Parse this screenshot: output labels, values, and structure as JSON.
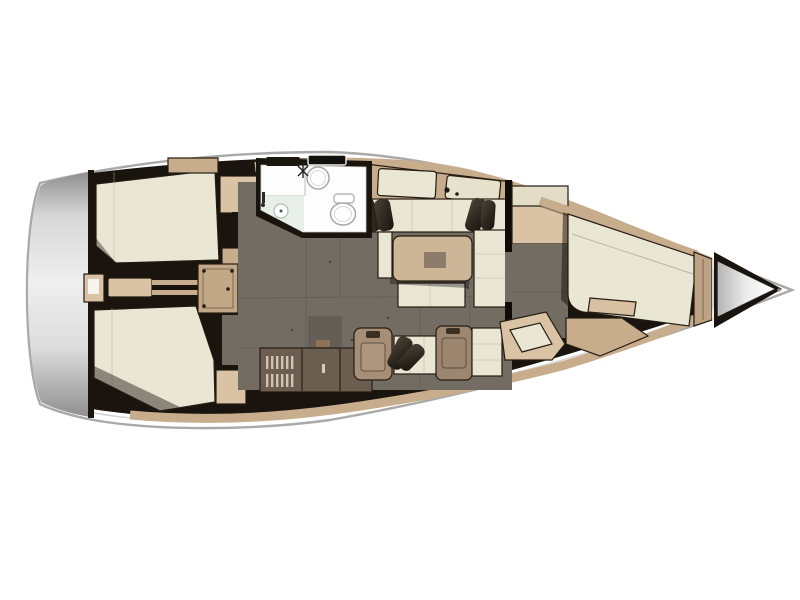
{
  "meta": {
    "description": "Top-down interior layout plan of a sailing yacht, bow pointing right, rendered on a white background with no text labels",
    "view": "deck plan",
    "orientation": "bow-right"
  },
  "palette": {
    "background": "#ffffff",
    "hull_fill": "#ffffff",
    "hull_stroke": "#a9a9a9",
    "deck_line": "#d2d2d2",
    "walls": "#19140e",
    "transom_light": "#efefef",
    "transom_dark": "#8f8f8f",
    "floor": "#726c63",
    "floor_seam": "#5f584e",
    "berth": "#eae6d4",
    "wood": "#c8ad8d",
    "wood_light": "#d9c3a4",
    "wood_dark": "#8d7459",
    "steps": "#b69b7c",
    "galley_cabinet": "#6b5e50",
    "module_brown": "#a68f76",
    "nav_module": "#9c8670",
    "pillow": "#26211a",
    "table": "#ccb697",
    "table_center": "#8d7c69",
    "fixture_white": "#fdfdfd",
    "fixture_stroke": "#a8a8a8",
    "shower": "#e7efe8",
    "vent_slat": "#cfc4b2"
  },
  "regions": [
    {
      "id": "transom",
      "label": "stern transom / swim platform"
    },
    {
      "id": "aft-cabin-port",
      "label": "aft double cabin, port side with berth"
    },
    {
      "id": "aft-cabin-starboard",
      "label": "aft double cabin, starboard side with berth"
    },
    {
      "id": "companionway",
      "label": "companionway steps and engine compartment"
    },
    {
      "id": "head",
      "label": "head with sink, toilet and shower"
    },
    {
      "id": "salon",
      "label": "salon with settees, cushions and table"
    },
    {
      "id": "galley",
      "label": "galley cabinets with louvered vents and cool-box"
    },
    {
      "id": "nav-station",
      "label": "navigation seat and desk modules"
    },
    {
      "id": "forward-cabin",
      "label": "forward cabin with angled V-berth"
    },
    {
      "id": "anchor-locker",
      "label": "bow anchor locker"
    }
  ],
  "fixtures": [
    {
      "id": "sink",
      "label": "round wash basin with mixer tap"
    },
    {
      "id": "toilet",
      "label": "marine toilet with cistern"
    },
    {
      "id": "shower-drain",
      "label": "shower tray drain"
    },
    {
      "id": "salon-table",
      "label": "salon table with inset"
    },
    {
      "id": "companionway-steps",
      "label": "ribbed companionway steps"
    },
    {
      "id": "engine-hatch",
      "label": "engine compartment hatch"
    },
    {
      "id": "louvered-vents",
      "label": "louvered locker doors"
    },
    {
      "id": "deck-hatches",
      "label": "deck hatches above the head"
    },
    {
      "id": "mast-foot",
      "label": "mast foot fittings"
    }
  ]
}
